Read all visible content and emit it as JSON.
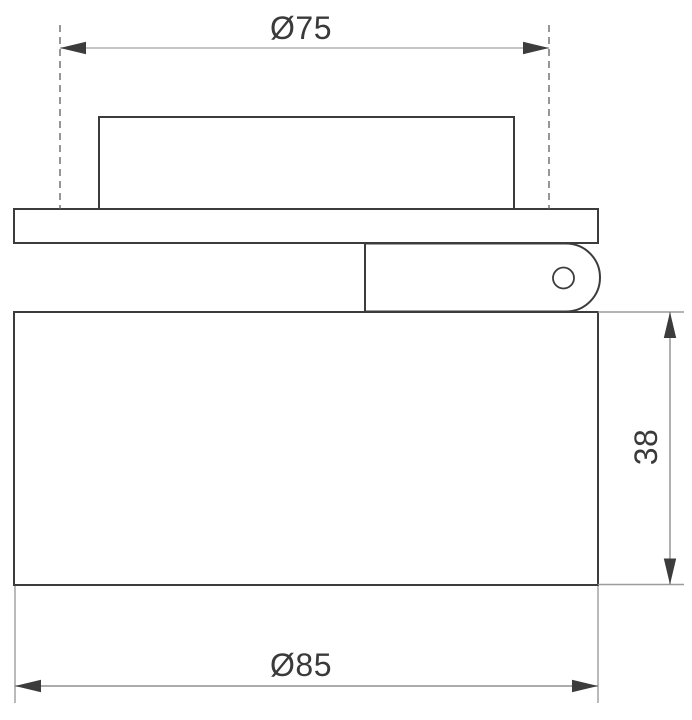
{
  "drawing": {
    "kind": "technical dimension drawing - luminaire side section",
    "dimensions": {
      "top_diameter": "Ø75",
      "bottom_diameter": "Ø85",
      "side_height": "38"
    },
    "colors": {
      "outline": "#3c3c3c",
      "dimension_line": "#8f8f8f",
      "top_dimension_line": "#b2b2b2",
      "extension_line": "#9c9c9c",
      "dashed_extension_line": "#5f5f5f",
      "arrowhead": "#3c3c3c",
      "text": "#3a3a3a",
      "background": "#ffffff"
    }
  }
}
